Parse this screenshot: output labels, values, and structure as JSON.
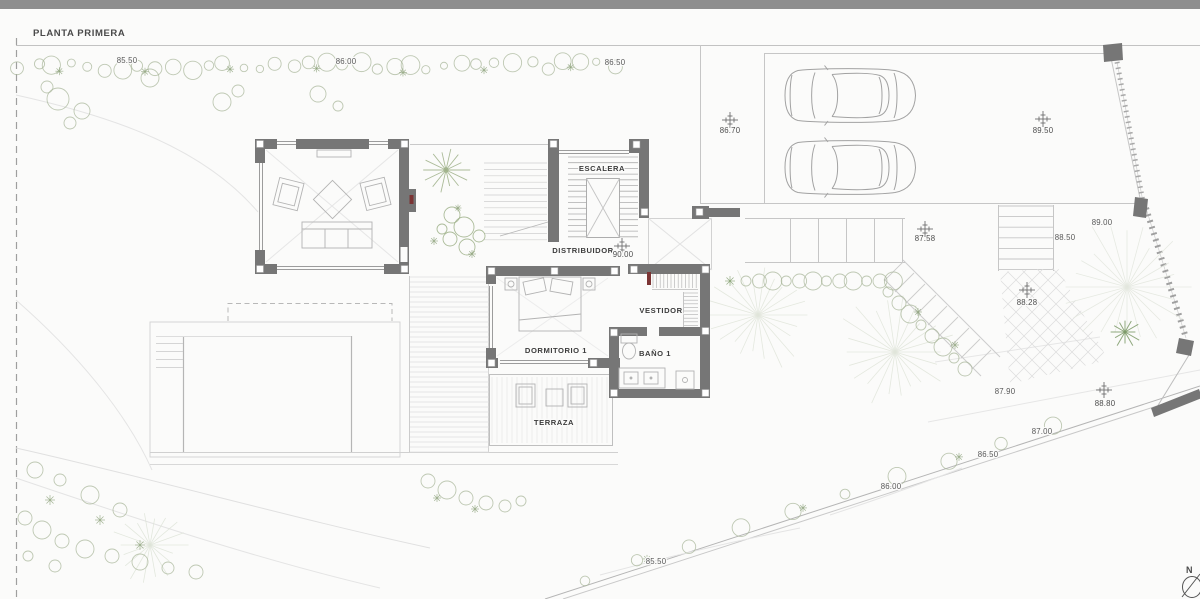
{
  "title": "PLANTA PRIMERA",
  "north": {
    "label": "N"
  },
  "colors": {
    "wall": "#767676",
    "door": "#7b3434",
    "text": "#3f3f3f",
    "vegetation": "#a9b79b",
    "accent_line": "#c4c4c4"
  },
  "room_labels": [
    {
      "name": "escalera",
      "text": "ESCALERA",
      "x": 602,
      "y": 171
    },
    {
      "name": "distribuidor",
      "text": "DISTRIBUIDOR",
      "x": 583,
      "y": 253
    },
    {
      "name": "dormitorio-1",
      "text": "DORMITORIO 1",
      "x": 556,
      "y": 353
    },
    {
      "name": "vestidor",
      "text": "VESTIDOR",
      "x": 661,
      "y": 313
    },
    {
      "name": "bano-1",
      "text": "BAÑO 1",
      "x": 655,
      "y": 356
    },
    {
      "name": "terraza",
      "text": "TERRAZA",
      "x": 554,
      "y": 425
    }
  ],
  "spot_levels": [
    {
      "text": "86.70",
      "x": 730,
      "y": 133,
      "marker_x": 730,
      "marker_y": 120
    },
    {
      "text": "89.50",
      "x": 1043,
      "y": 133,
      "marker_x": 1043,
      "marker_y": 119
    },
    {
      "text": "90.00",
      "x": 623,
      "y": 257,
      "marker_x": 622,
      "marker_y": 246
    },
    {
      "text": "87.58",
      "x": 925,
      "y": 241,
      "marker_x": 925,
      "marker_y": 229
    },
    {
      "text": "88.28",
      "x": 1027,
      "y": 305,
      "marker_x": 1027,
      "marker_y": 290
    },
    {
      "text": "88.80",
      "x": 1105,
      "y": 406,
      "marker_x": 1104,
      "marker_y": 390
    }
  ],
  "contour_levels": [
    {
      "text": "85.50",
      "x": 127,
      "y": 63
    },
    {
      "text": "86.00",
      "x": 346,
      "y": 64
    },
    {
      "text": "86.50",
      "x": 615,
      "y": 65
    },
    {
      "text": "89.00",
      "x": 1102,
      "y": 225
    },
    {
      "text": "88.50",
      "x": 1065,
      "y": 240
    },
    {
      "text": "87.90",
      "x": 1005,
      "y": 394
    },
    {
      "text": "87.00",
      "x": 1042,
      "y": 434
    },
    {
      "text": "86.50",
      "x": 988,
      "y": 457
    },
    {
      "text": "86.00",
      "x": 891,
      "y": 489
    },
    {
      "text": "85.50",
      "x": 656,
      "y": 564
    }
  ]
}
